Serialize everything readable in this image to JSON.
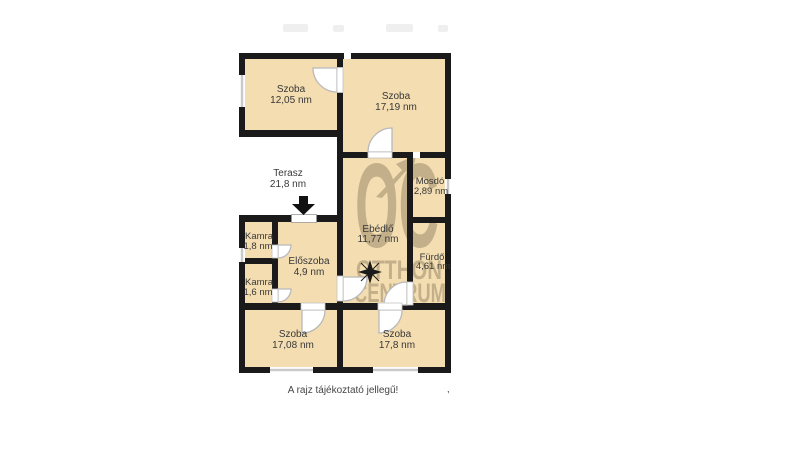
{
  "rooms": [
    {
      "id": "szoba-12",
      "name": "Szoba",
      "area": "12,05 nm"
    },
    {
      "id": "szoba-17",
      "name": "Szoba",
      "area": "17,19 nm"
    },
    {
      "id": "terasz",
      "name": "Terasz",
      "area": "21,8 nm"
    },
    {
      "id": "mosdo",
      "name": "Mosdó",
      "area": "2,89 nm"
    },
    {
      "id": "ebedlo",
      "name": "Ebédlő",
      "area": "11,77 nm"
    },
    {
      "id": "furdo",
      "name": "Fürdő",
      "area": "4,61 nm"
    },
    {
      "id": "kamra-1",
      "name": "Kamra",
      "area": "1,8 nm"
    },
    {
      "id": "kamra-2",
      "name": "Kamra",
      "area": "1,6 nm"
    },
    {
      "id": "eloszoba",
      "name": "Előszoba",
      "area": "4,9 nm"
    },
    {
      "id": "szoba-bl",
      "name": "Szoba",
      "area": "17,08 nm"
    },
    {
      "id": "szoba-br",
      "name": "Szoba",
      "area": "17,8 nm"
    }
  ],
  "watermark": {
    "logo": "OC",
    "line1": "OTTHON",
    "line2": "CENTRUM"
  },
  "footer": {
    "note": "A rajz tájékoztató jellegű!",
    "mark": ","
  },
  "colors": {
    "room_fill": "#f3ddb1",
    "wall": "#1a1a1a",
    "watermark": "#8a7a5c",
    "door_arc": "#b9b9b9",
    "window_line": "#c9c9c9",
    "label_text": "#383838"
  }
}
